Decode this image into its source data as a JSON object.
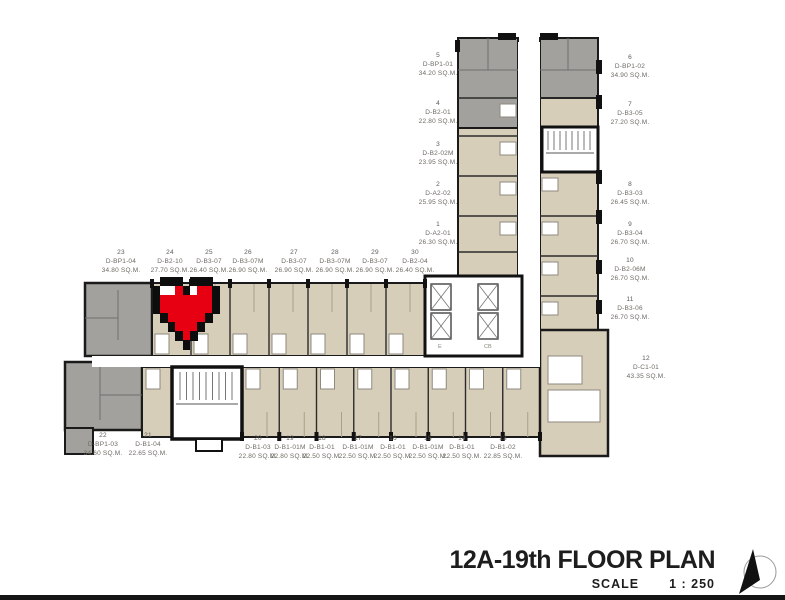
{
  "title": {
    "name": "12A-19th FLOOR PLAN",
    "scale_label": "SCALE",
    "scale_value": "1 : 250"
  },
  "marker": {
    "type": "pixel-heart",
    "color": "#e60012"
  },
  "core": {
    "elevator_label": "E",
    "secondary_label": "CB"
  },
  "colors": {
    "unit_beige": "#d7ceba",
    "unit_gray": "#a3a19d",
    "wall": "#1a1a1a",
    "heart_red": "#e60012",
    "label_text": "#6e6a62"
  },
  "units": [
    {
      "no": "1",
      "code": "D-A2-01",
      "area": "26.30 SQ.M."
    },
    {
      "no": "2",
      "code": "D-A2-02",
      "area": "25.95 SQ.M."
    },
    {
      "no": "3",
      "code": "D-B2-02M",
      "area": "23.95 SQ.M."
    },
    {
      "no": "4",
      "code": "D-B2-01",
      "area": "22.80 SQ.M."
    },
    {
      "no": "5",
      "code": "D-BP1-01",
      "area": "34.20 SQ.M."
    },
    {
      "no": "6",
      "code": "D-BP1-02",
      "area": "34.90 SQ.M."
    },
    {
      "no": "7",
      "code": "D-B3-05",
      "area": "27.20 SQ.M."
    },
    {
      "no": "8",
      "code": "D-B3-03",
      "area": "26.45 SQ.M."
    },
    {
      "no": "9",
      "code": "D-B3-04",
      "area": "26.70 SQ.M."
    },
    {
      "no": "10",
      "code": "D-B2-06M",
      "area": "26.70 SQ.M."
    },
    {
      "no": "11",
      "code": "D-B3-06",
      "area": "26.70 SQ.M."
    },
    {
      "no": "12",
      "code": "D-C1-01",
      "area": "43.35 SQ.M."
    },
    {
      "no": "13",
      "code": "D-B1-02",
      "area": "22.85 SQ.M."
    },
    {
      "no": "14",
      "code": "D-B1-01",
      "area": "22.50 SQ.M."
    },
    {
      "no": "15",
      "code": "D-B1-01M",
      "area": "22.50 SQ.M."
    },
    {
      "no": "16",
      "code": "D-B1-01",
      "area": "22.50 SQ.M."
    },
    {
      "no": "17",
      "code": "D-B1-01M",
      "area": "22.50 SQ.M."
    },
    {
      "no": "18",
      "code": "D-B1-01",
      "area": "22.50 SQ.M."
    },
    {
      "no": "19",
      "code": "D-B1-01M",
      "area": "22.80 SQ.M."
    },
    {
      "no": "20",
      "code": "D-B1-03",
      "area": "22.80 SQ.M."
    },
    {
      "no": "21",
      "code": "D-B1-04",
      "area": "22.65 SQ.M."
    },
    {
      "no": "22",
      "code": "D-BP1-03",
      "area": "34.60 SQ.M."
    },
    {
      "no": "23",
      "code": "D-BP1-04",
      "area": "34.80 SQ.M."
    },
    {
      "no": "24",
      "code": "D-B2-10",
      "area": "27.70 SQ.M."
    },
    {
      "no": "25",
      "code": "D-B3-07",
      "area": "26.40 SQ.M."
    },
    {
      "no": "26",
      "code": "D-B3-07M",
      "area": "26.90 SQ.M."
    },
    {
      "no": "27",
      "code": "D-B3-07",
      "area": "26.90 SQ.M."
    },
    {
      "no": "28",
      "code": "D-B3-07M",
      "area": "26.90 SQ.M."
    },
    {
      "no": "29",
      "code": "D-B3-07",
      "area": "26.90 SQ.M."
    },
    {
      "no": "30",
      "code": "D-B2-04",
      "area": "26.40 SQ.M."
    }
  ]
}
